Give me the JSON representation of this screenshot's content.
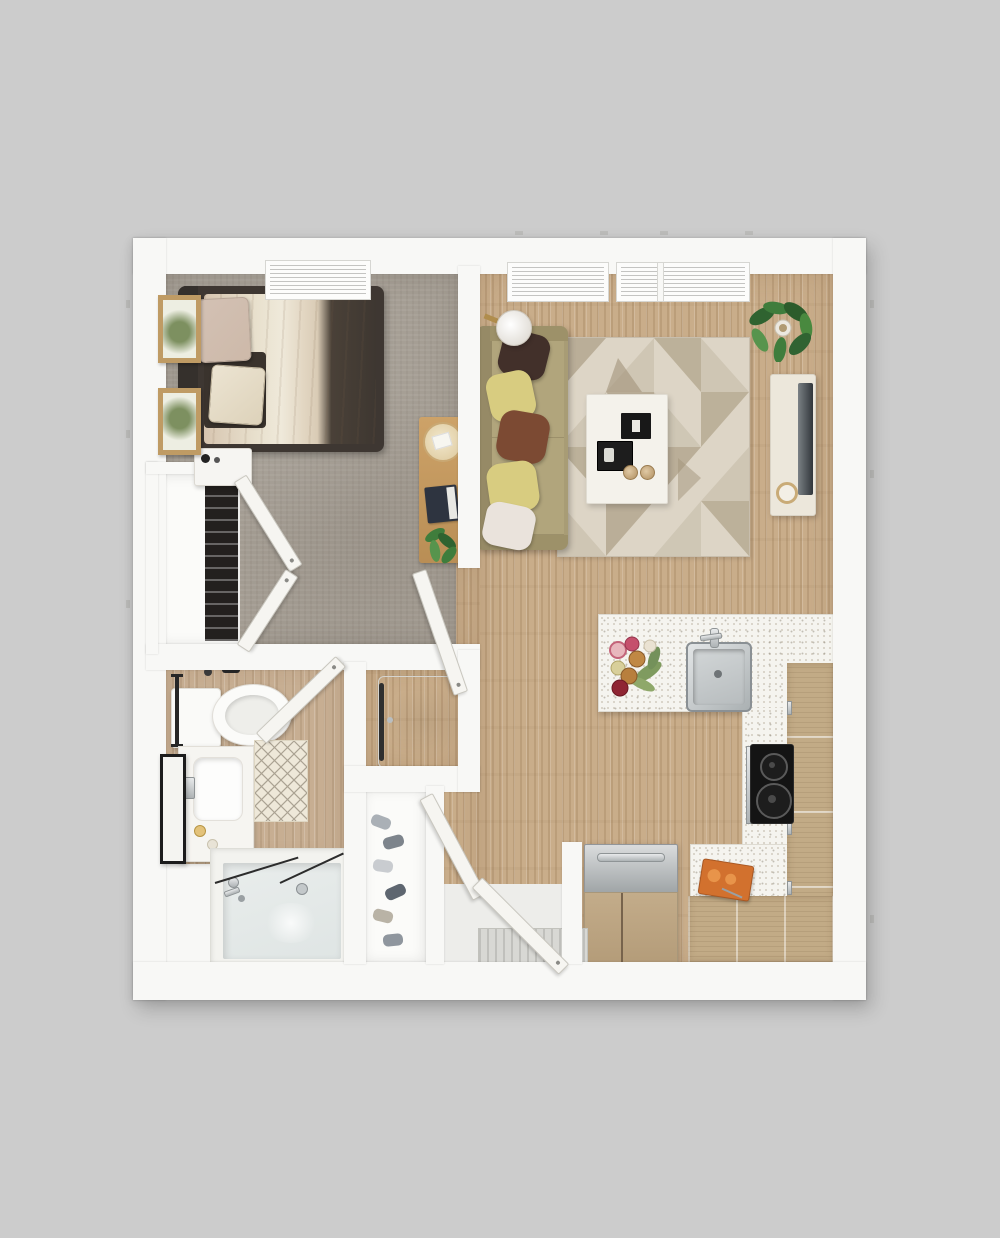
{
  "image_type": "3d-floor-plan-top-down-render",
  "title": "One-bedroom one-bath apartment floor plan",
  "palette": {
    "background": "#cccccc",
    "wall": "#f8f8f6",
    "carpet": "#a49d93",
    "wood": "#c9ad8a",
    "bath_wood": "#c7ae92",
    "counter_speckle": "#f5f4ef",
    "cabinet_wood": "#c2ab86",
    "rug_base": "#ddd5c6",
    "rug_triangle": "#b4a78f",
    "rug_triangle_light": "#cdc4b1",
    "sofa": "#a89c75",
    "pillow_dark_brown": "#42302a",
    "pillow_yellow": "#d8cc80",
    "pillow_rust": "#7c4a33",
    "pillow_white": "#eae3dc",
    "bed_frame": "#3e3732",
    "bedding_cream": "#e8e0cd",
    "bedding_blush": "#cdb9a9",
    "stool": "#5b3f2e",
    "stool_edge": "#c89f6c",
    "cooktop": "#141414",
    "steel_light": "#dadcdd",
    "steel_dark": "#9fa4a6",
    "tv": "#31363b",
    "console": "#ece7db",
    "plant_green": "#3f7d3c",
    "door": "#f6f5f1",
    "door_edge": "#c9c7bf",
    "tub": "#e9edec",
    "glass_line": "#2c2c2c",
    "mat": "#eee8d9",
    "mat_line": "#8e8575",
    "board_orange": "#d2712e"
  },
  "plan": {
    "rooms": [
      {
        "id": "bedroom",
        "label": "Bedroom",
        "floor": "gray carpet",
        "position": "top-left",
        "items": [
          "double bed",
          "dark upholstered bed frame",
          "two throw pillows",
          "nightstand with bottle",
          "two wood wall frames",
          "window with blinds",
          "wood bench with tray, books and plant",
          "reach-in closet with hanging clothes",
          "bifold closet doors",
          "entry door"
        ]
      },
      {
        "id": "living-room",
        "label": "Living Room",
        "floor": "hardwood",
        "position": "top-right",
        "items": [
          "sofa with five throw pillows",
          "floor lamp",
          "geometric area rug",
          "white coffee table with books, tray and two cups",
          "media console",
          "flat TV",
          "potted fiddle-leaf plant",
          "two windows with blinds"
        ]
      },
      {
        "id": "kitchen",
        "label": "Kitchen",
        "floor": "hardwood",
        "position": "right",
        "items": [
          "peninsula counter with speckled top",
          "four bar stools",
          "stainless sink with faucet",
          "flower arrangement",
          "two-burner black cooktop",
          "tall pantry cabinet",
          "base cabinets",
          "refrigerator with bar handle",
          "orange cutting board"
        ]
      },
      {
        "id": "bathroom",
        "label": "Bathroom",
        "floor": "hardwood",
        "position": "bottom-left",
        "items": [
          "toilet",
          "towel bar",
          "vanity with sink and faucet",
          "framed mirror",
          "diamond-pattern bath mat",
          "bathtub with glass shower panels",
          "tub faucet",
          "drain"
        ]
      },
      {
        "id": "laundry-closet",
        "label": "Laundry Closet",
        "position": "center",
        "items": [
          "stacked washer-dryer"
        ]
      },
      {
        "id": "entry",
        "label": "Entry",
        "position": "bottom-center",
        "items": [
          "front door (open)",
          "secondary door leaf",
          "door mat",
          "entry closet with shoes"
        ]
      }
    ],
    "counts": {
      "bar_stools": 4,
      "windows": 3,
      "sofa_pillows": 5,
      "wall_frames": 2,
      "cooktop_burners": 2
    }
  }
}
